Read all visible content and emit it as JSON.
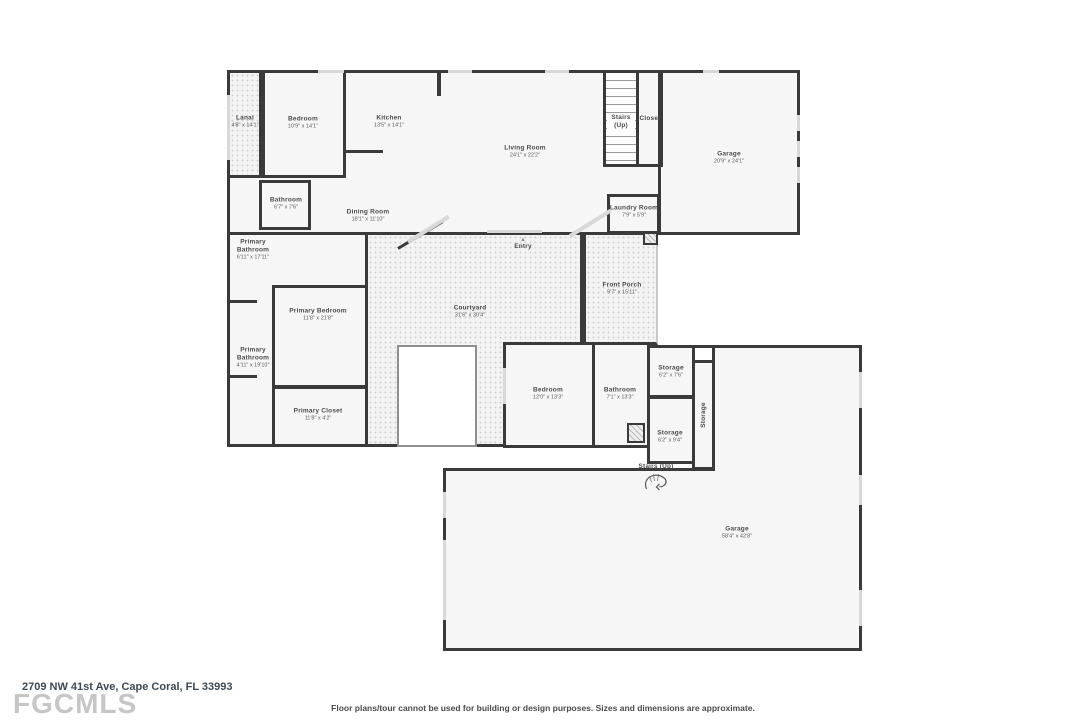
{
  "floor_plan": {
    "address": "2709 NW 41st Ave, Cape Coral, FL 33993",
    "disclaimer": "Floor plans/tour cannot be used for building or design purposes. Sizes and dimensions are approximate.",
    "logo": "FGCMLS",
    "icons": {
      "entry_marker": "▲",
      "spiral_stairs": "spiral-stairs"
    },
    "rooms": [
      {
        "name": "Lanai",
        "dims": "4'8\" x 14'1\""
      },
      {
        "name": "Bedroom",
        "dims": "10'9\" x 14'1\""
      },
      {
        "name": "Kitchen",
        "dims": "13'5\" x 14'1\""
      },
      {
        "name": "Living Room",
        "dims": "24'1\" x 22'2\""
      },
      {
        "name": "Stairs (Up)",
        "dims": ""
      },
      {
        "name": "Closet",
        "dims": ""
      },
      {
        "name": "Garage",
        "dims": "20'9\" x 24'1\""
      },
      {
        "name": "Bathroom",
        "dims": "6'7\" x 7'6\""
      },
      {
        "name": "Dining Room",
        "dims": "18'1\" x 11'10\""
      },
      {
        "name": "Laundry Room",
        "dims": "7'9\" x 5'9\""
      },
      {
        "name": "Primary Bathroom",
        "dims": "6'11\" x 17'11\""
      },
      {
        "name": "Entry",
        "dims": ""
      },
      {
        "name": "Front Porch",
        "dims": "9'7\" x 15'11\""
      },
      {
        "name": "Courtyard",
        "dims": "31'6\" x 30'4\""
      },
      {
        "name": "Primary Bedroom",
        "dims": "11'8\" x 21'8\""
      },
      {
        "name": "Primary Bathroom",
        "dims": "4'11\" x 19'10\""
      },
      {
        "name": "Primary Closet",
        "dims": "11'8\" x 4'2\""
      },
      {
        "name": "Bedroom",
        "dims": "12'0\" x 13'3\""
      },
      {
        "name": "Bathroom",
        "dims": "7'1\" x 13'3\""
      },
      {
        "name": "Storage",
        "dims": "6'2\" x 7'6\""
      },
      {
        "name": "Storage",
        "dims": "6'2\" x 9'4\""
      },
      {
        "name": "Storage",
        "dims": ""
      },
      {
        "name": "Stairs (Up)",
        "dims": ""
      },
      {
        "name": "Garage",
        "dims": "58'4\" x 42'8\""
      }
    ]
  }
}
